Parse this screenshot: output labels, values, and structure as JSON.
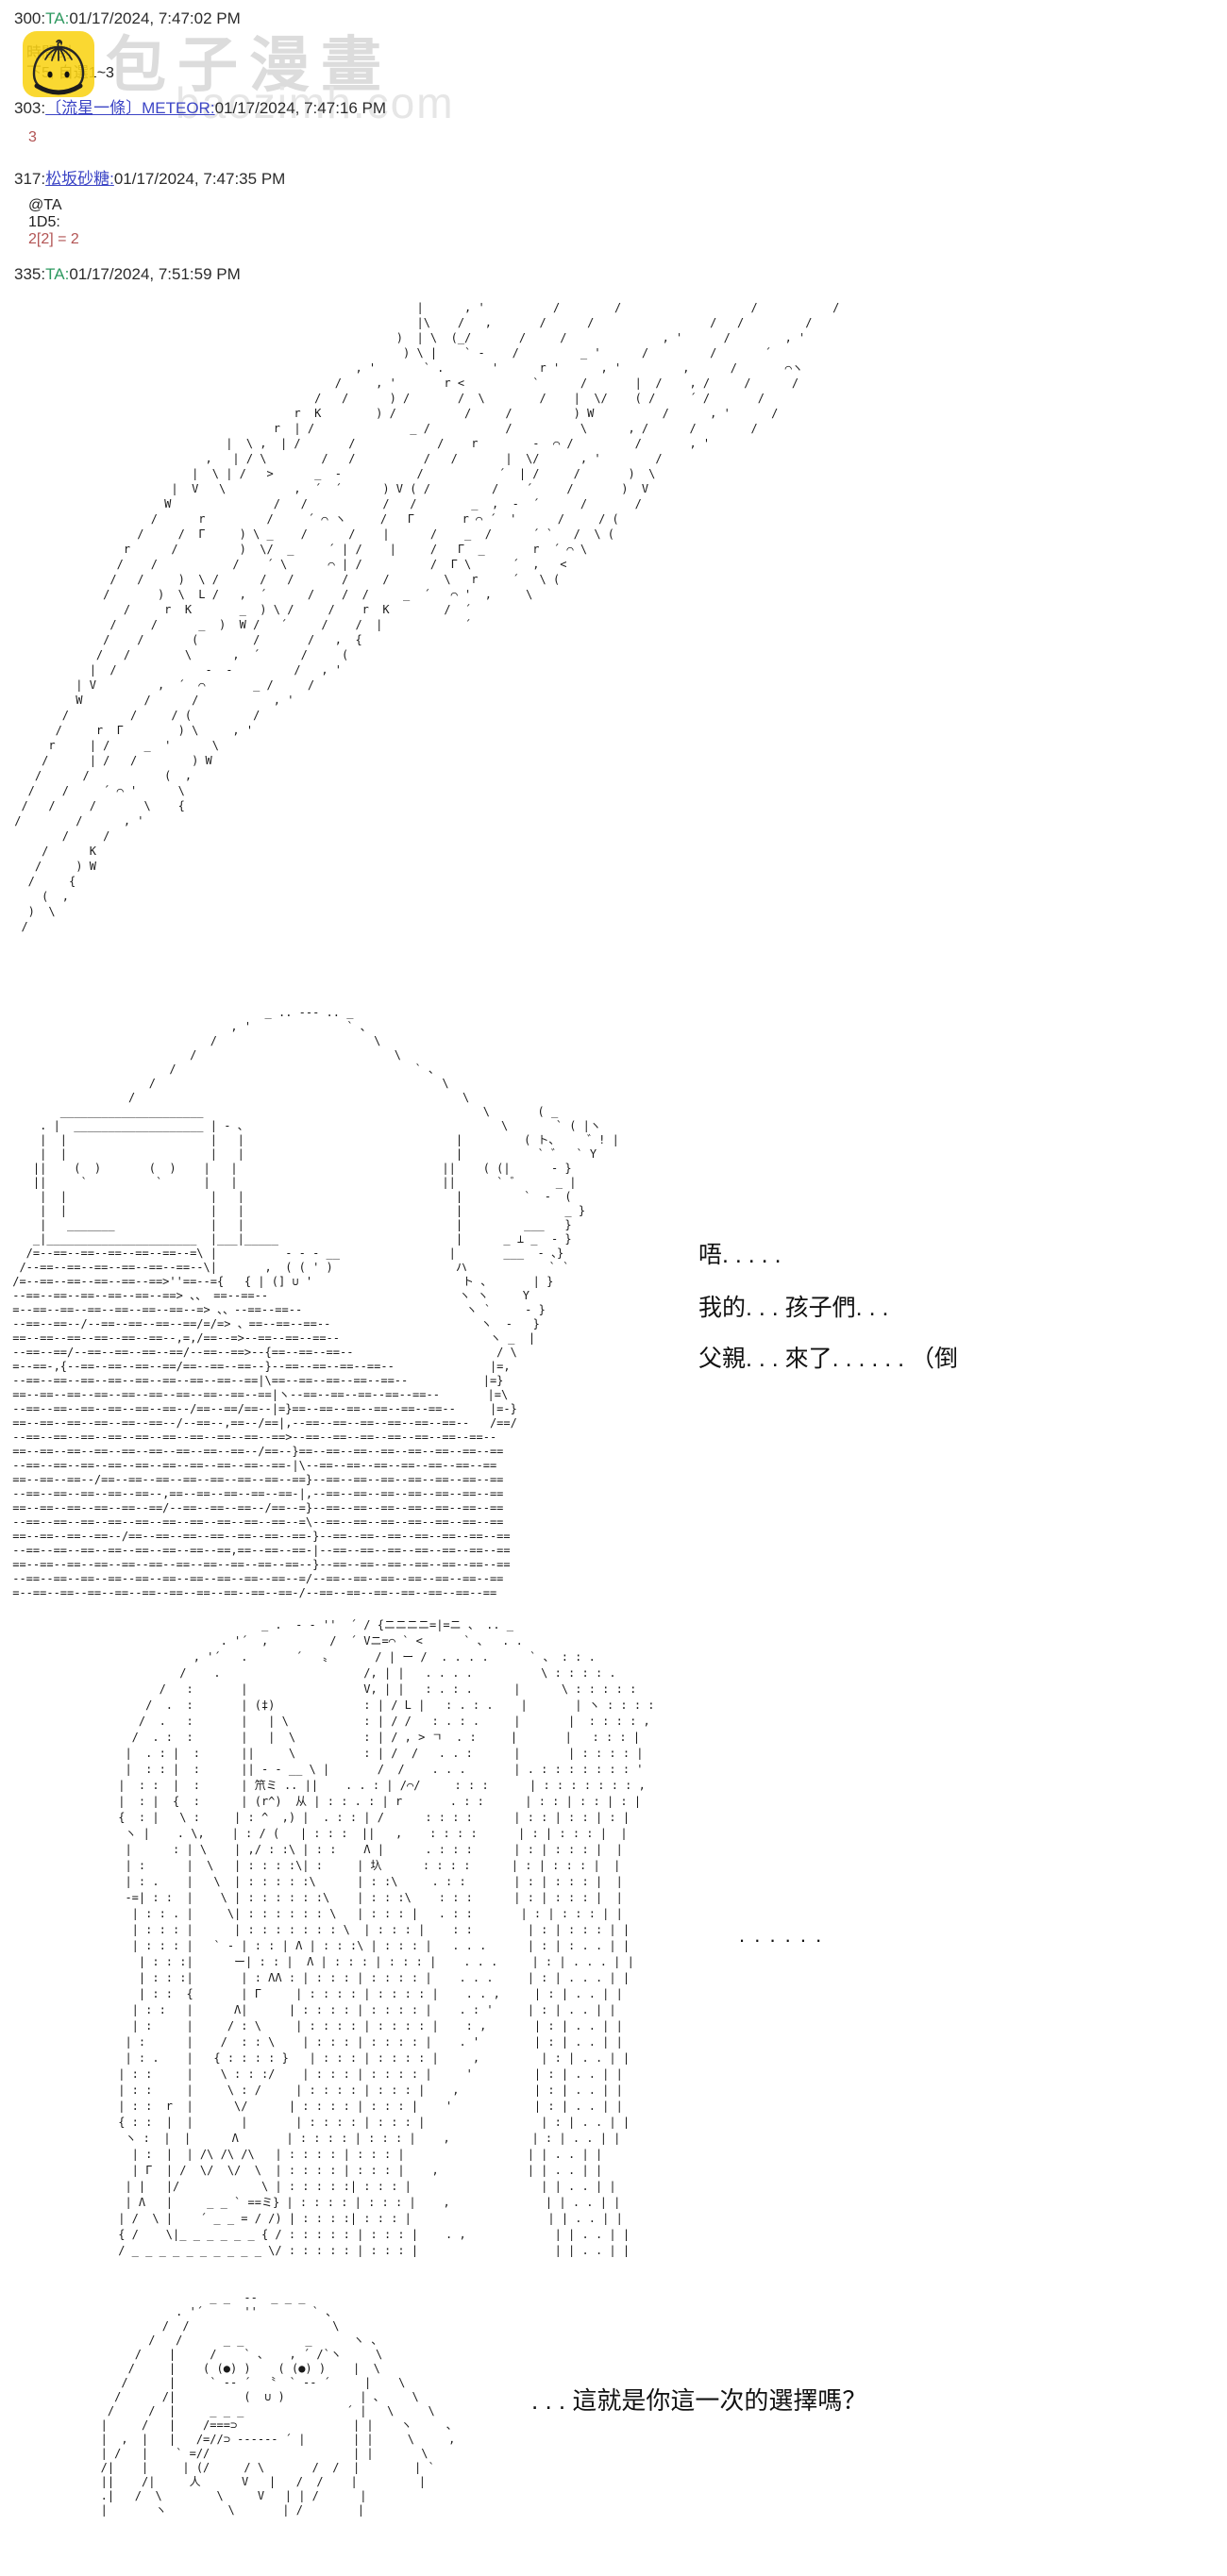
{
  "watermark": {
    "title": "包子漫畫",
    "domain": "baozimh.com"
  },
  "colors": {
    "link_blue": "#3c45c5",
    "author_green": "#2e9960",
    "dice_red": "#b25454",
    "logo_yellow": "#f9d315",
    "watermark_grey": "#dcdcdc"
  },
  "posts": [
    {
      "num": "300",
      "author": "TA",
      "time": "01/17/2024, 7:47:02 PM",
      "lines": [
        "時間到",
        "下5, 自選1~3"
      ]
    },
    {
      "num": "303",
      "author": "〔流星一條〕METEOR",
      "time": "01/17/2024, 7:47:16 PM",
      "roll": "3"
    },
    {
      "num": "317",
      "author": "松坂砂糖",
      "time": "01/17/2024, 7:47:35 PM",
      "mention": "@TA",
      "dice": "1D5:",
      "roll": "2[2] = 2"
    },
    {
      "num": "335",
      "author": "TA",
      "time": "01/17/2024, 7:51:59 PM"
    }
  ],
  "dialogues": {
    "a1": "唔. . . . .",
    "a2": "我的. . . 孩子們. . .",
    "a3": "父親. . . 來了. . . . . . （倒",
    "b1": ". . . . . .",
    "c1": ". . . 這就是你這一次的選擇嗎？"
  },
  "aa": {
    "speed_lines": [
      "                                                            |      , '          /        /                   /           /",
      "                                                            |\\    /   ,       /      /                 /   /         /",
      "                                                         )  | \\  (_/       /     /              , '      /        , '",
      "                                                          ) \\ |    ` -    /         _ '      /         /       ´",
      "                                                   , '       ` .       '      r '      , '         ,      /       ⌒ヽ",
      "                                                /     , '       r <          `      /       |  /    , /     /      /",
      "                                             /   /      ) /       /  \\        /    |  \\/    ( /     ´ /       /",
      "                                          r  K        ) /          /     /         ) W          /      , '      /",
      "                                       r  | /              _ /           /          \\      , /      /        /",
      "                                |  \\ ,  | /       /            /    r        -  ⌒ /         /       , '",
      "                             ,   | / \\        /   /          /   /       |  \\/      , '        /",
      "                           |  \\ | /   >      _  -           /           ´  | /     /       )  \\",
      "                        |  V   \\          ,  ´  ´      ) V ( /         /    ´     /       )  V",
      "                       W               /   /           /   /        _  ,  -  ´      /       /",
      "                     /      r         /     ´ ⌒ ヽ     /   Γ       r ⌒ ´  '      /     / (",
      "                   /     /  Γ     ) \\ _    /      /    |      /    _  /      ´ `   /  \\ (",
      "                 r      /         )  \\/  _     ´ | /    |     /   Γ  _       r  ´ ⌒ \\",
      "                /    /           /    ´ \\      ⌒ | /          /  Γ \\      ´  ,   <",
      "               /   /     )  \\ /      /   /       /     /        \\   r     ´   \\ (",
      "              /       )  \\  L /   ,  ´      /    /  /     _  ´   ⌒ '  ,     \\",
      "                 /     r  K       _  ) \\ /     /    r  K        /  ´",
      "               /     /      _  )  W /   ´     /    /  |            ´",
      "              /    /       (        /       /   ,  {",
      "             /   /        \\      ,  ´      /     (",
      "            |  /             -  -         /   , '",
      "          | V         ,  ´  ⌒       _ /     /",
      "          W         /      /           , '",
      "        /         /     / (         /",
      "       /     r  Γ        ) \\     , '",
      "      r     | /     _  '      \\",
      "     /      | /   /        ) W",
      "    /      /           (  ,",
      "   /    /     ´ ⌒ '      \\",
      "  /   /     /       \\    {",
      " /        /      , '",
      "        /     /",
      "     /      K",
      "    /     ) W",
      "   /     {",
      "     (  ,",
      "   )  \\",
      "  /",
      ""
    ],
    "robot_scene": [
      "                                      _ .. -‐- .. _",
      "                                 , '              ` 、",
      "                              /                       \\",
      "                           /                             \\",
      "                        /                                   ` 、",
      "                     /                                          \\",
      "                  /                                                \\",
      "        _____________________                                         \\       ( _",
      "     . |  ___________________ | - 、                                     \\       ` ( |ヽ",
      "     |  |                     |   |                               |         ( ト、    ゛! |",
      "     |  |                     |   |                               |           ` ゛  ` Y",
      "    ||    (  )       (  )    |   |                              ||    ( (|      - }",
      "    ||     `          `      |   |                              ||      ` ゛     _ |",
      "     |  |                     |   |                               |         `  -  (",
      "     |  |                     |   |                               |               _ }",
      "     |   _______              |   |                               |         ___   }",
      "    _|______________________  |___|_____                          |      _ ⊥ _  - }",
      "   /=--==--==--==--==--==--=\\ |          - - - __                |       ___  - 、}",
      "  /--==--==--==--==--==--==--\\|       ,  ( ( ' )                  ハ            ` `",
      " /=--==--==--==--==--==>''==--={   { | (] ∪ '                      ト 、      | }",
      " --==--==--==--==--==--==> 、、 ==--==--                            ヽ ヽ     Y",
      " =--==--==--==--==--==--==--=> 、、--==--==--                        ヽ `     - }",
      " --==--==--/--==--==--==--==/=/=> 、==--==--==--                      ヽ  -   }",
      " ==--==--==--==--==--==--,=,/==--=>--==--==--==--                      ヽ _  |",
      " --==--==/--==--==--==--==/--==--==>--{==--==--==--                     / \\",
      " =--==-,{--==--==--==--==/==--==--==--}--==--==--==--==--              |=,",
      " --==--==--==--==--==--==--==--==--==|\\==--==--==--==--==--           |=}",
      " ==--==--==--==--==--==--==--==--==--==|ヽ--==--==--==--==--==--       |=\\",
      " --==--==--==--==--==--==--/==--==/==--|=}==--==--==--==--==--==--     |=-}",
      " ==--==--==--==--==--==--/--==--,==--/==|,--==--==--==--==--==--==--   /==/",
      " --==--==--==--==--==--==--==--==--==--==>--==--==--==--==--==--==--==--",
      " ==--==--==--==--==--==--==--==--==--/==--}==--==--==--==--==--==--==--==",
      " --==--==--==--==--==--==--==--==--==--==-|\\--==--==--==--==--==--==--==",
      " ==--==--==--/==--==--==--==--==--==--==--==}--==--==--==--==--==--==--==",
      " --==--==--==--==--==--,==--==--==--==--==-|,--==--==--==--==--==--==--==",
      " ==--==--==--==--==--==/--==--==--==--/==--=}--==--==--==--==--==--==--==",
      " --==--==--==--==--==--==--==--==--==--==--=\\--==--==--==--==--==--==--==",
      " ==--==--==--==--/==--==--==--==--==--==--==-}--==--==--==--==--==--==--==",
      " --==--==--==--==--==--==--==--==,==--==--==-|--==--==--==--==--==--==--==",
      " ==--==--==--==--==--==--==--==--==--==--==--}--==--==--==--==--==--==--==",
      " --==--==--==--==--==--==--==--==--==--==--=/--==--==--==--==--==--==--==",
      " =--==--==--==--==--==--==--==--==--==--==-/--==--==--==--==--==--==--=="
    ],
    "priest_figure": [
      "                      _ .  - ‐ ''  ´ / {ニニニニ=|=ニ 、 .. _",
      "                . '´  ,         /  ´ Vニ=⌒ ` <      ` 、  . .",
      "            , '´   .       ´   〟      / | ー /  . . . .      ` 、 : : .",
      "          /    .                     /, | |   . . . .          \\ : : : : .",
      "       /   :       |                 V, | |   : . : .      |      \\ : : : : :",
      "     /  .  :       | (‡)             : | / L |   : . : .    |       | ヽ : : : :",
      "    /  .   :       |   | \\           : | / /   : . : .     |       |  : : : : ,",
      "   /  . :  :       |   |  \\          : | / , > ㄱ  . :     |       |   : : : |",
      "  |  . : |  :      ||     \\          : | /  /   . . :      |       | : : : : |",
      "  |  : : |  :      || - - __ \\ |       /  /    . . .       | . : : : : : : : '",
      " |  : :  |  :      | 笊ミ .. ||    . . : | /⌒/     : : :      | : : : : : : : ,",
      " |  : |  {  :      | (r^)  从 | : : . : | r       . : :      | : : | : : | : |",
      " {  : |   \\ :     | : ^  ,) |  . : : | /      : : : :      | : : | : : | : |",
      "  ヽ |    . \\,    | : / (   | : : :  ||   ,    : : : :      | : | : : : |  |",
      "  |      : | \\    | ,/ : :\\ | : :    Λ |      . : : :      | : | : : : |  |",
      "  | :      |  \\   | : : : :\\| :     | 圦      : : : :      | : | : : : |  |",
      "  | : .    |   \\  | : : : : :\\      | : :\\     . : :       | : | : : : |  |",
      "  -=| : :  |    \\ | : : : : : :\\    | : : :\\    : : :      | : | : : : |  |",
      "   | : : . |     \\| : : : : : : \\   | : : : |   . : :       | : | : : : | |",
      "   | : : : |      | : : : : : : : \\  | : : : |    : :        | : | : : : | |",
      "   | : : : |   ` - | : : | Λ | : : :\\ | : : : |   . . .      | : | : . . | |",
      "    | : : :|      ー| : : |  Λ | : : : | : : : |    . . .     | : | . . . | |",
      "    | : : :|       | : ΛΛ : | : : : | : : : : |    . . .     | : | . . . | |",
      "    | : :  {       | Γ     | : : : : | : : : : |    . . ,     | : | . . | |",
      "   | : :   |      Λ|      | : : : : | : : : : |    . : '     | : | . . | |",
      "   | :     |     / : \\     | : : : : | : : : : |    : ,       | : | . . | |",
      "  | :      |    /  : : \\    | : : : | : : : : |    . '        | : | . . | |",
      "  | : .    |   { : : : : }   | : : : | : : : : |     ,         | : | . . | |",
      " | : :     |    \\ : : :/    | : : : | : : : : |     '         | : | . . | |",
      " | : :     |     \\ : /     | : : : : | : : : |    ,           | : | . . | |",
      " | : :  r  |      \\/      | : : : : | : : : |    '            | : | . . | |",
      " { : :  |  |       |       | : : : : | : : : |                 | : | . . | |",
      "  ヽ :  |  |      Λ       | : : : : | : : : |    ,            | : | . . | |",
      "   | :  |  | /\\ /\\ /\\   | : : : : | : : : |                  | | . . | |",
      "   | Γ  | /  \\/  \\/  \\  | : : : : | : : : |    ,             | | . . | |",
      "  | |   |/            \\ | : : : : :| : : : |                   | | . . | |",
      "  | Λ   |     _ _ ` ==ミ} | : : : : | : : : |    ,              | | . . | |",
      " | /  \\ |    ´ _ _ = / /) | : : : :| : : : |                    | | . . | |",
      " { /    \\|_ _ _ _ _ _ { / : : : : : | : : : |    . ,             | | . . | |",
      " / _ _ _ _ _ _ _ _ _ _ \\/ : : : : : | : : : |                    | | . . | |"
    ],
    "creature": [
      "                   _ _  --  _ _ _",
      "              . '´      ''        ` 、",
      "            /  /                     \\",
      "          /   /      _ _         _      ヽ 、",
      "        /    |     /    ` 、   , ´ /`ヽ     \\",
      "       /     |    ( (●) )    ( (●) )    |  \\",
      "      /      |     ` -- ´  〝  ` -- ´     |    \\",
      "     /      /|          (  ∪ )           | 、    \\",
      "    /     /  |     _ _ _               ´ |   \\     \\",
      "   |     /   |    /===⊃                 | |    ヽ     、",
      "   |  ,  |   |   /=//⊃ ------ ´ |       | |     \\     ,",
      "   | /   |    ` =//                     | |       \\",
      "   /|    |     | (/     / \\       /  /  |        | `",
      "   ||    /|     人      V   |   /  /    |         |",
      "   .|   /  \\        \\     V   | | /      |",
      "   |       ヽ         \\       | /        |",
      "",
      ""
    ]
  }
}
